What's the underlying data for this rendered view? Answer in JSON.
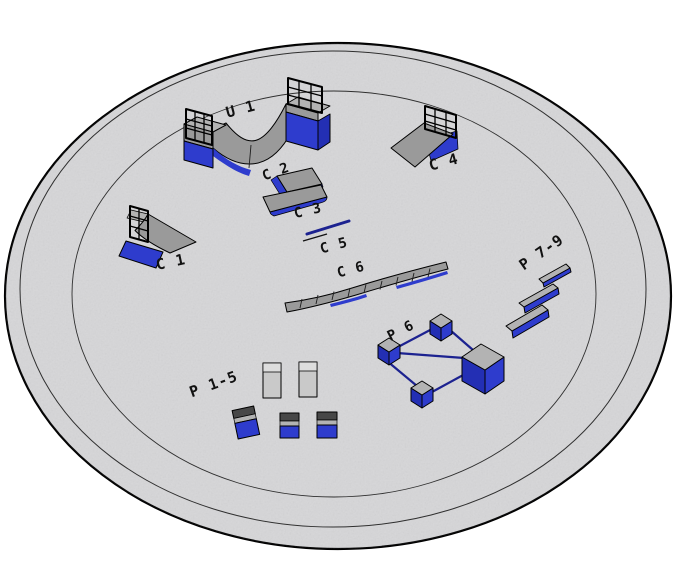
{
  "scene": {
    "title": "Skatepark obstacle layout plan",
    "pad_shape": "circular pad with rim ring and inner ring"
  },
  "colors": {
    "background": "#ffffff",
    "pad_fill": "#d6d6d8",
    "pad_outline": "#000000",
    "ring_stroke": "#2f2f2f",
    "gray_top": "#b3b3b3",
    "gray_face": "#9a9a9a",
    "gray_dark": "#474747",
    "gray_box": "#c9c9c9",
    "gray_box_top": "#dddddd",
    "blue": "#2e3ccd",
    "blue_dark": "#232fb4",
    "rail_navy": "#1c2290",
    "outline": "#000000",
    "label": "#111111"
  },
  "labels": {
    "u1": "U 1",
    "c1": "C 1",
    "c2": "C 2",
    "c3": "C 3",
    "c4": "C 4",
    "c5": "C 5",
    "c6": "C 6",
    "p1_5": "P 1-5",
    "p6": "P 6",
    "p7_9": "P 7-9"
  }
}
